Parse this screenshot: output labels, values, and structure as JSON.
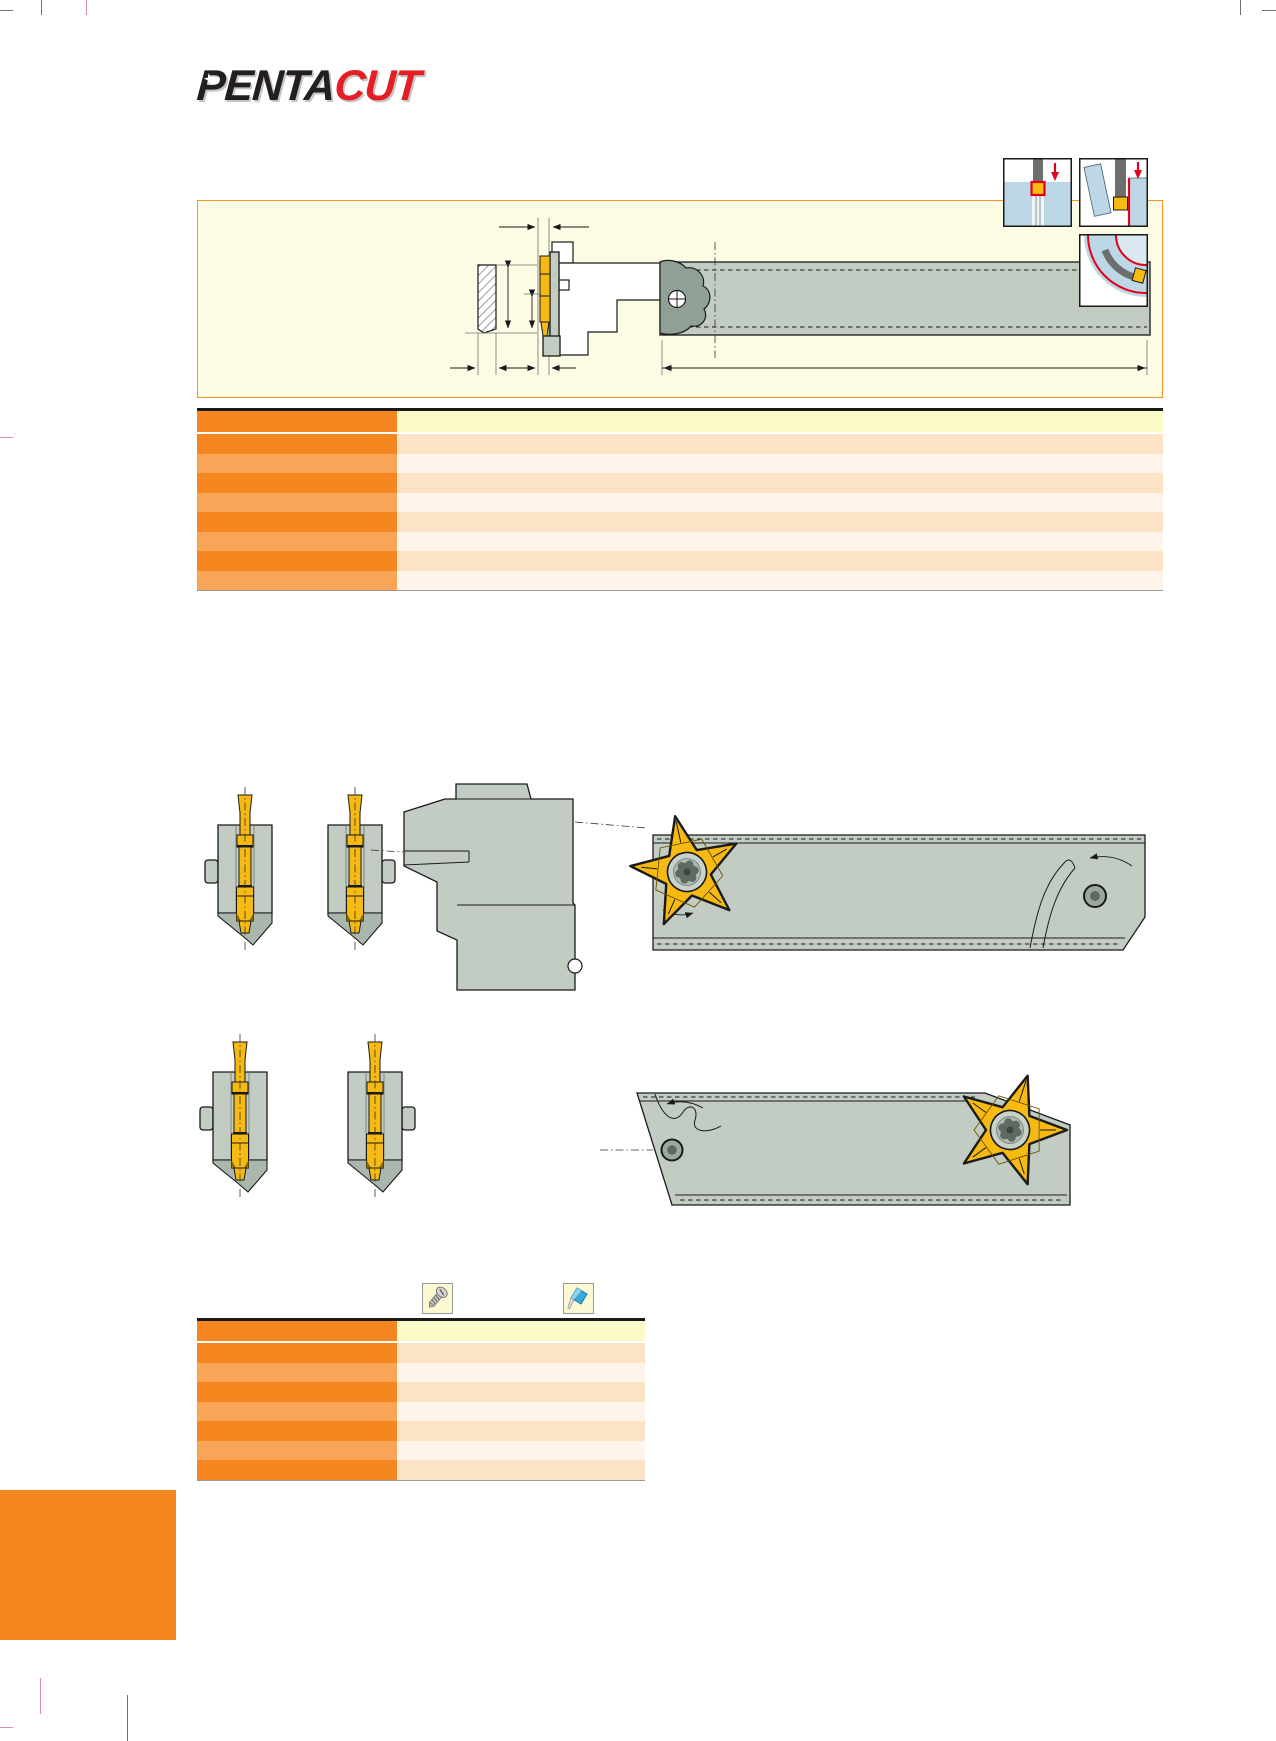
{
  "logo": {
    "primary": "PENTA",
    "accent": "CUT",
    "star_glyph": "★"
  },
  "colors": {
    "accent_orange": "#F6861F",
    "accent_orange_light": "#F9A557",
    "row_peach": "#FCE3C6",
    "row_peach_light": "#FEF4EA",
    "header_cream": "#FAF9C8",
    "panel_cream": "#FCFBE4",
    "panel_border": "#F7941D",
    "steel_gray": "#C2CCC2",
    "steel_gray_dark": "#8FA096",
    "insert_yellow": "#F6BA12",
    "signal_red": "#E3001B",
    "workpiece_blue": "#BCD7E5",
    "logo_black": "#231F20",
    "logo_red": "#E31E24"
  },
  "tables": {
    "main": {
      "row_count": 8,
      "columns": 2
    },
    "spare_parts": {
      "row_count": 7,
      "columns": 2
    }
  },
  "icons": {
    "screw": "clamping-screw-icon",
    "marker": "marker-pen-icon"
  },
  "diagrams": {
    "top_right": [
      "external-grooving",
      "parting",
      "internal-profiling"
    ]
  }
}
